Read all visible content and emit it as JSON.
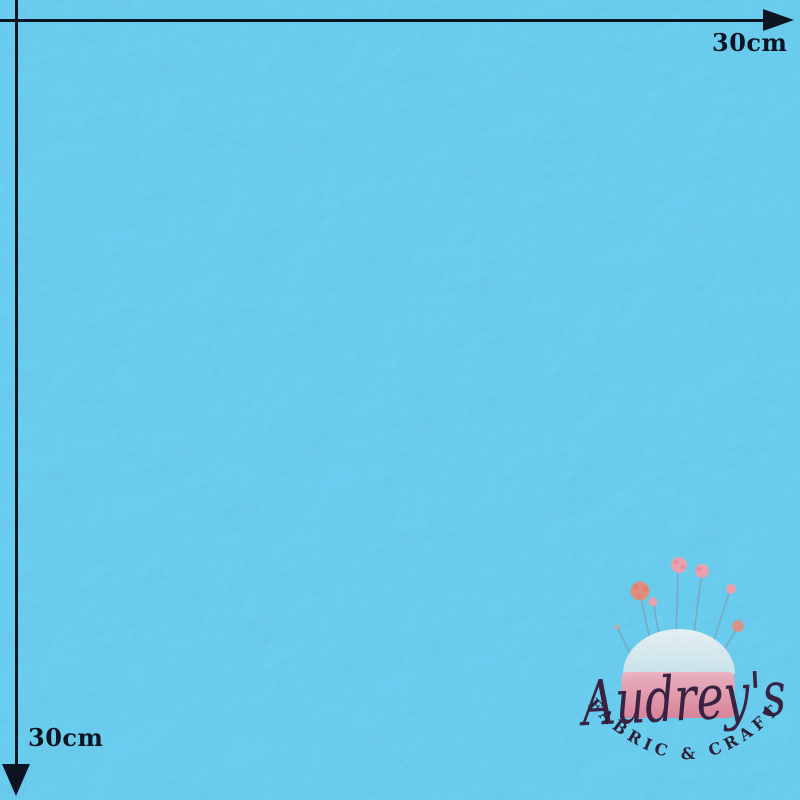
{
  "measurements": {
    "width_label": "30cm",
    "height_label": "30cm"
  },
  "logo": {
    "brand": "Audrey's",
    "tagline": "FABRIC & CRAFT"
  },
  "colors": {
    "ink": "#0d1522",
    "fabric": "#53c8f0",
    "logo-script": "#3a2243",
    "logo-tagline": "#2d2037",
    "cushion-dome": "#eef2f3",
    "cushion-dome-shade": "#cfe3ea",
    "cushion-pink-top": "#f2b0bd",
    "cushion-pink-bottom": "#e07e93",
    "pin-stem": "#7fa3b8",
    "pin-head-pink": "#e8a1ae",
    "pin-head-coral": "#df8f80"
  }
}
